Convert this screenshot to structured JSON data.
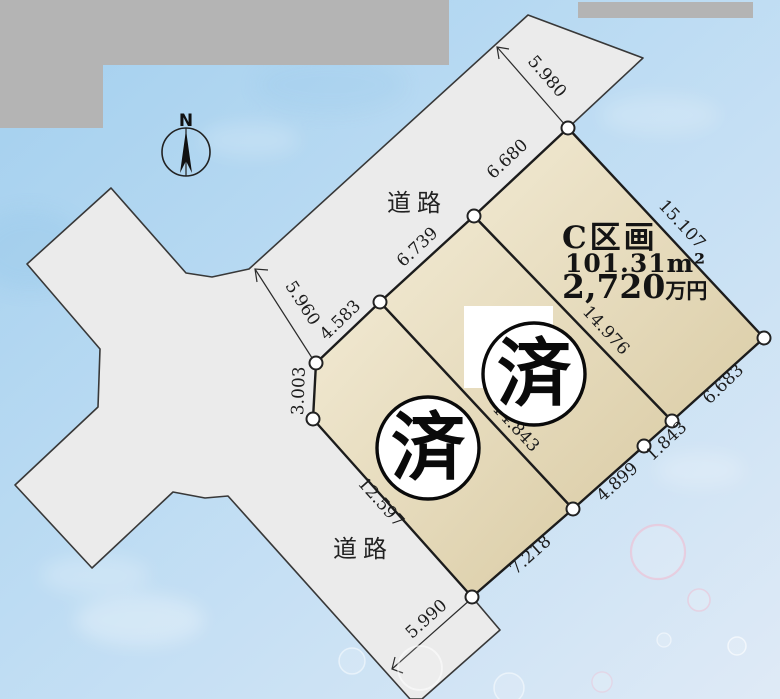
{
  "compass": {
    "north_label": "N"
  },
  "road_labels": {
    "top": "道路",
    "bottom": "道路"
  },
  "parcels": {
    "c": {
      "name": "C区画",
      "area": "101.31m²",
      "price_value": "2,720",
      "price_unit": "万円"
    },
    "sold_marks": [
      "済",
      "済"
    ]
  },
  "dimensions": [
    "5.980",
    "6.680",
    "6.739",
    "4.583",
    "3.003",
    "5.960",
    "15.107",
    "14.976",
    "14.843",
    "12.597",
    "6.683",
    "1.843",
    "4.899",
    "7.218",
    "5.990"
  ],
  "palette": {
    "sky_top": "#a2cfee",
    "sky_mid": "#bddcf3",
    "sky_bottom": "#dfeaf6",
    "road_fill": "#ebebeb",
    "parcel_light": "#f1e9d2",
    "parcel_dark": "#dbcda7",
    "outline": "#1c1c1c",
    "masked_gray": "#b4b4b4",
    "vertex_fill": "#ffffff",
    "bubble_rim": "#f0bcd0"
  }
}
